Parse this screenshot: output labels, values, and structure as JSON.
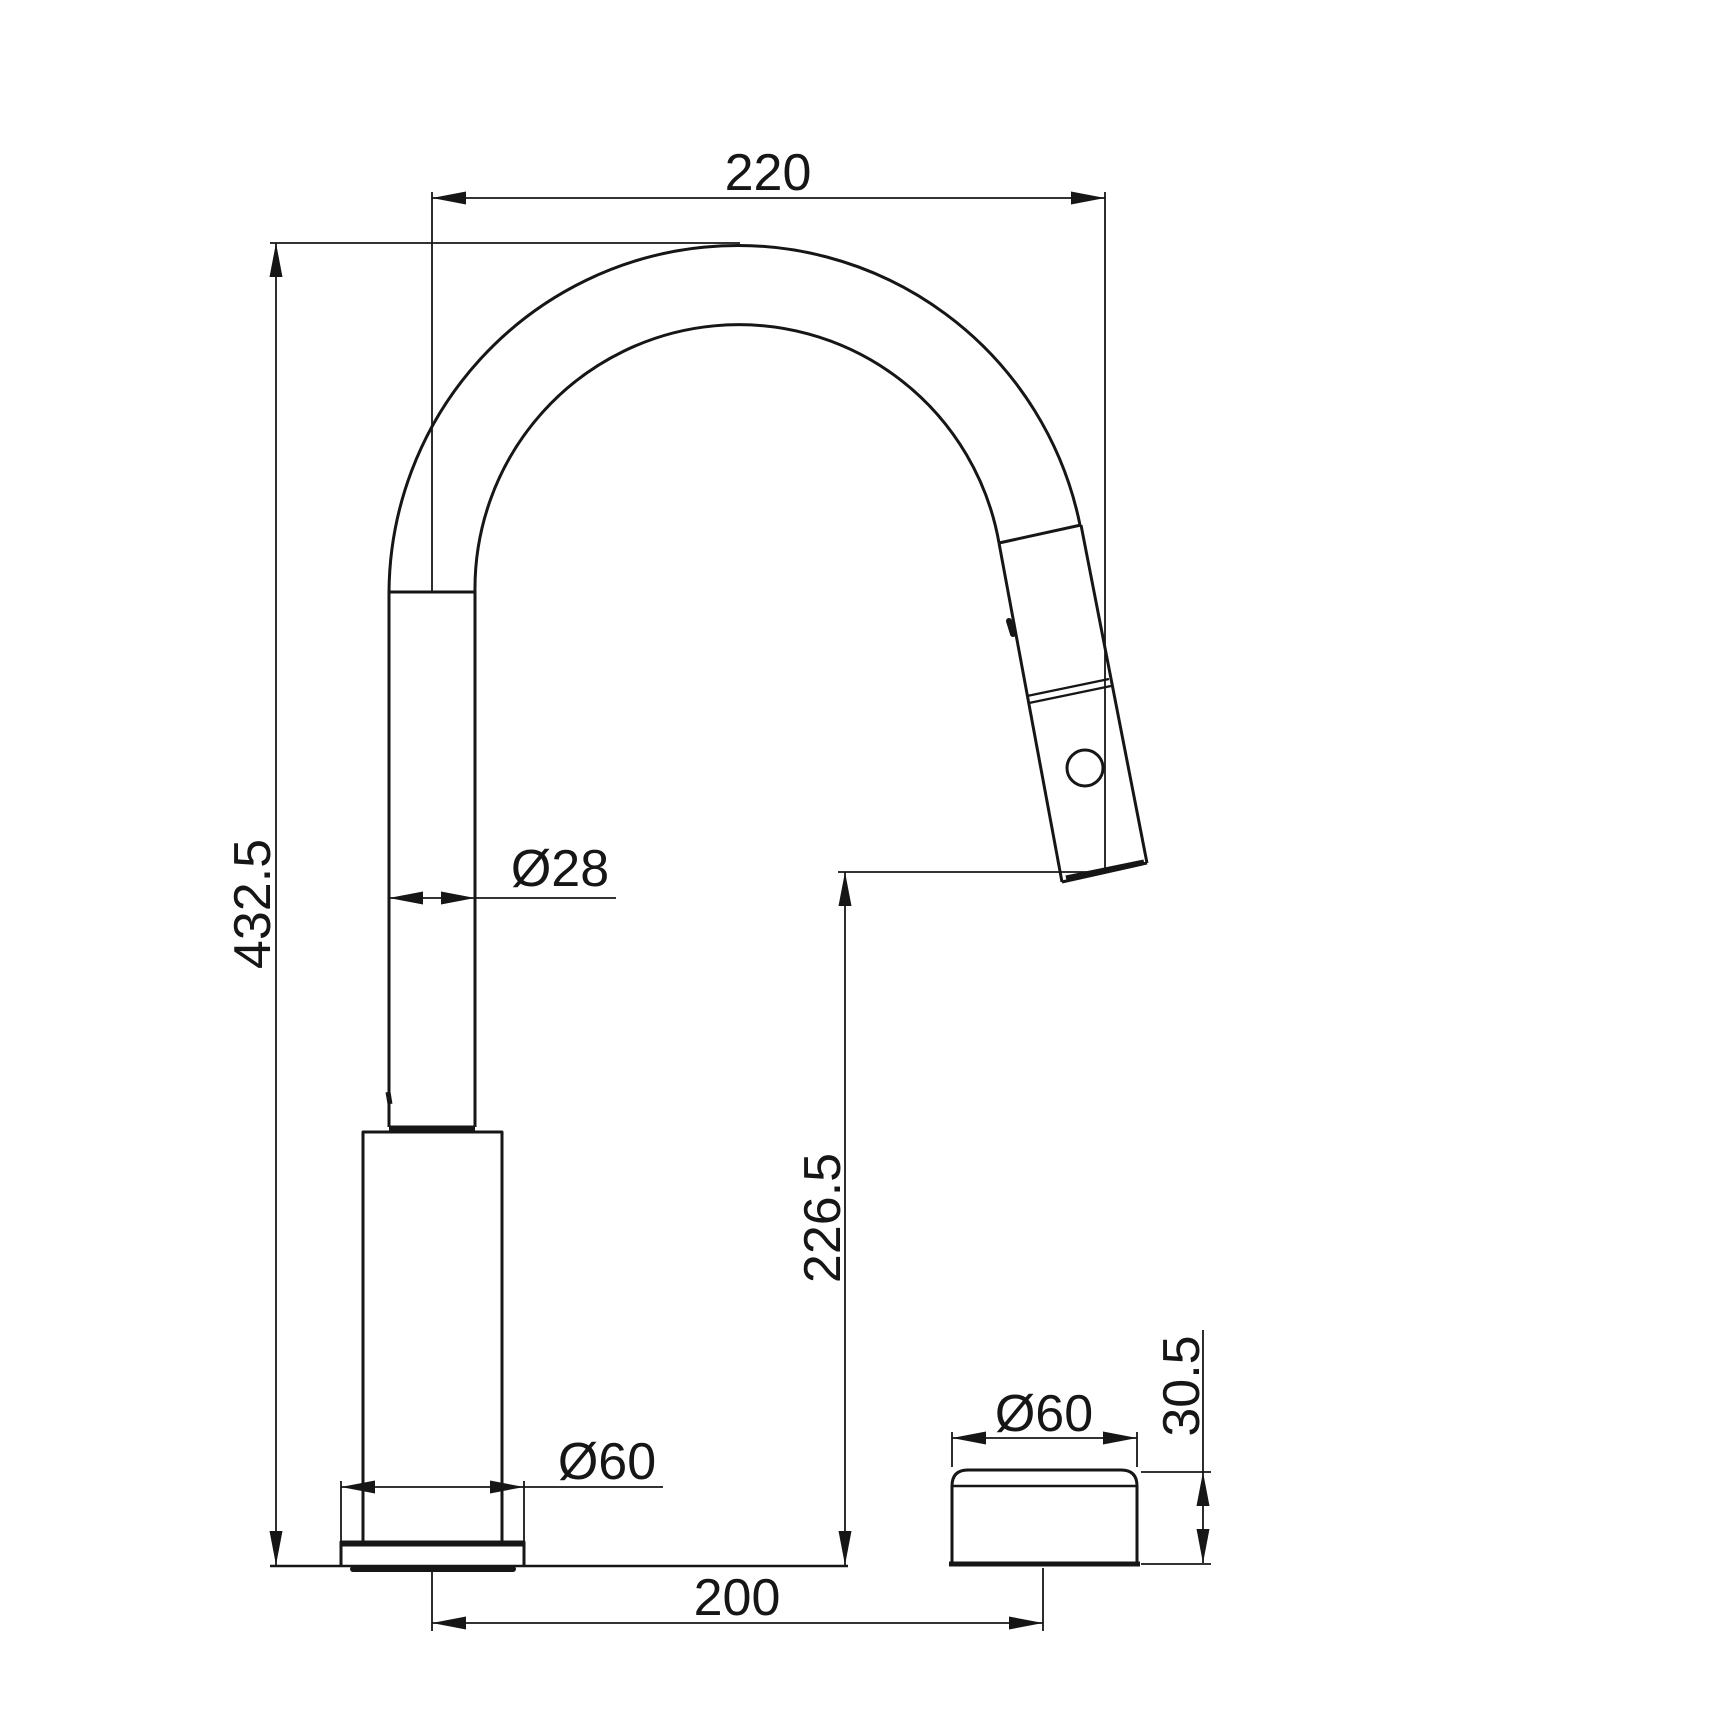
{
  "page": {
    "background": "#ffffff",
    "line_color": "#161616"
  },
  "drawing": {
    "type": "technical-dimension-drawing",
    "subject": "pull-down kitchen faucet with separate control knob, side elevation"
  },
  "dimensions": {
    "spout_reach": "220",
    "total_height": "432.5",
    "spout_tube_diameter": "Ø28",
    "outlet_height": "226.5",
    "base_diameter": "Ø60",
    "knob_diameter": "Ø60",
    "center_distance": "200",
    "knob_height": "30.5"
  }
}
